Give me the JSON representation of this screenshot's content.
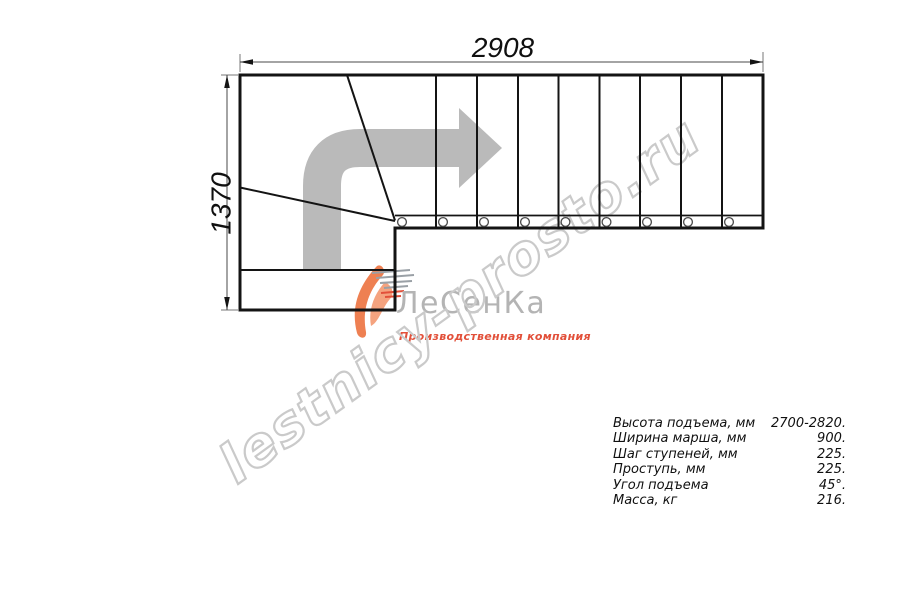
{
  "drawing": {
    "width_label": "2908",
    "height_label": "1370"
  },
  "watermark": {
    "text": "lestnicy-prosto.ru"
  },
  "logo": {
    "name": "ЛеСенКа",
    "tagline": "Производственная компания"
  },
  "specs": {
    "rows": [
      {
        "label": "Высота подъема, мм",
        "value": "2700-2820."
      },
      {
        "label": "Ширина марша, мм",
        "value": "900."
      },
      {
        "label": "Шаг ступеней, мм",
        "value": "225."
      },
      {
        "label": "Проступь, мм",
        "value": "225."
      },
      {
        "label": "Угол подъема",
        "value": "45°."
      },
      {
        "label": "Масса, кг",
        "value": "216."
      }
    ]
  },
  "colors": {
    "line": "#141414",
    "dim": "#4a4a4a",
    "arrow": "#bababa",
    "watermark": "#cacaca",
    "logo_name": "#b4b4b4",
    "logo_swoosh": "#ee8052",
    "logo_swoosh_light": "#f5a37f",
    "tagline": "#e2503a",
    "text": "#101010"
  }
}
